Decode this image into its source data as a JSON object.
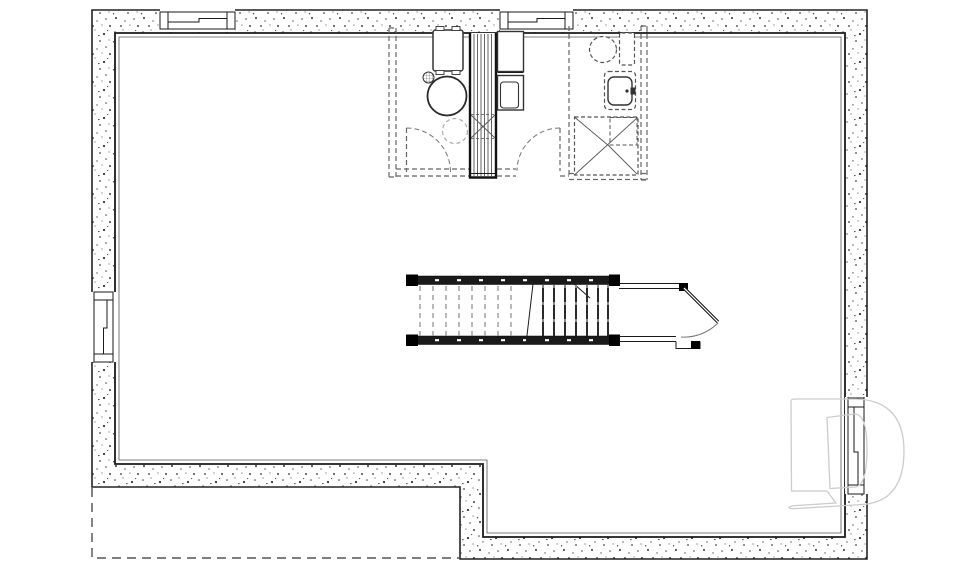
{
  "page": {
    "kind": "architectural floor plan drawing",
    "visible_text": ""
  },
  "colors": {
    "white": "#ffffff",
    "ink": "#1a1a1a",
    "wall": "#222222",
    "thin": "#555555",
    "future": "#666666",
    "tread": "#8a8a8a",
    "arc": "#777777",
    "logo": "#cccccc",
    "unexcavated": "#333333"
  }
}
